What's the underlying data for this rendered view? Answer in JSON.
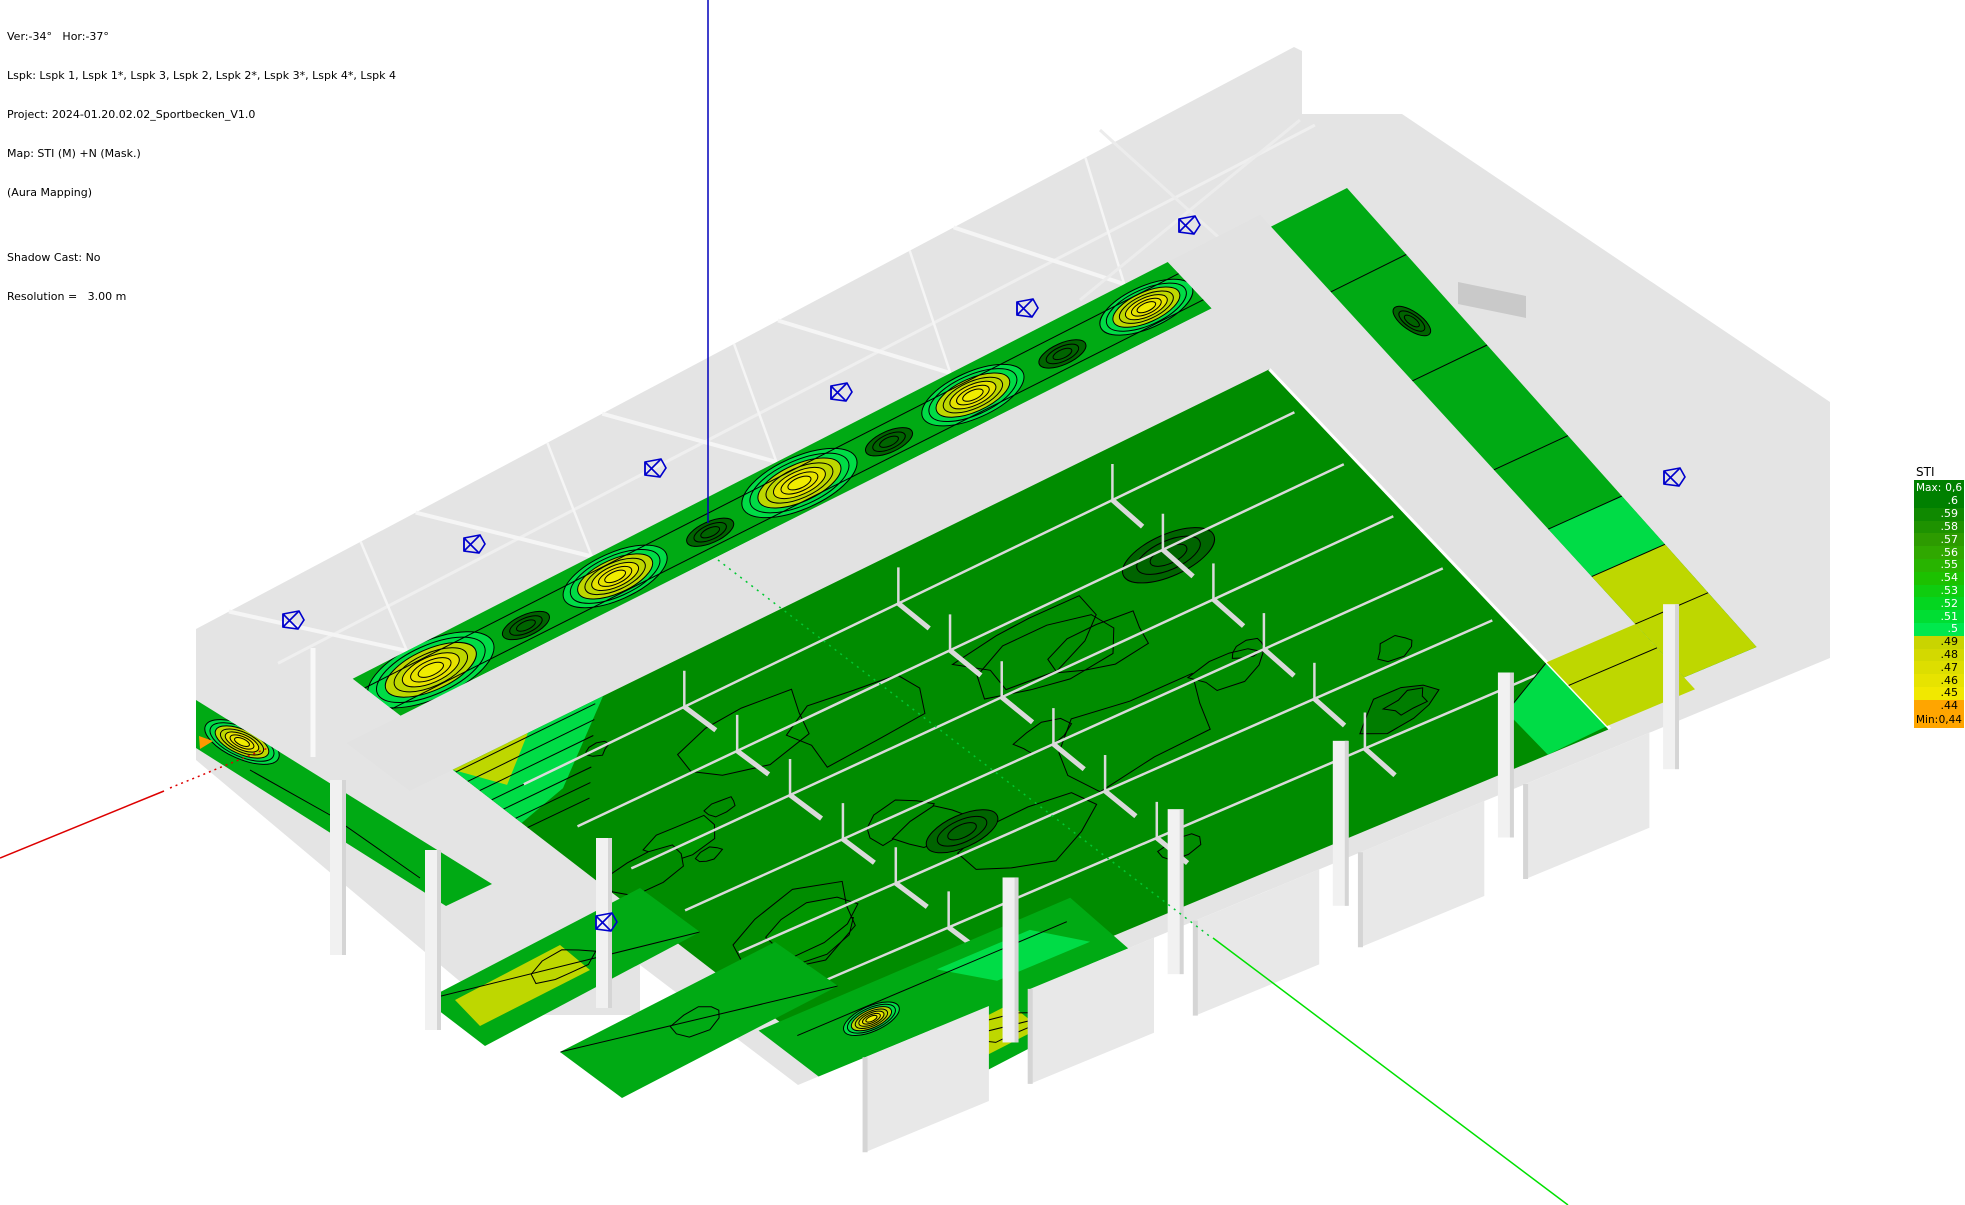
{
  "view": {
    "header_lines": [
      "Ver:-34°   Hor:-37°",
      "Lspk: Lspk 1, Lspk 1*, Lspk 3, Lspk 2, Lspk 2*, Lspk 3*, Lspk 4*, Lspk 4",
      "Project: 2024-01.20.02.02_Sportbecken_V1.0",
      "Map: STI (M) +N (Mask.)",
      "(Aura Mapping)",
      "",
      "Shadow Cast: No",
      "Resolution =   3.00 m"
    ]
  },
  "legend": {
    "title": "STI",
    "header": {
      "key": "Max:",
      "value": "0,6",
      "bg": "#008000",
      "fg": "#FFFFFF"
    },
    "footer": {
      "key": "Min:",
      "value": "0,44",
      "bg": "#FFA500",
      "fg": "#000000"
    },
    "rows": [
      {
        "label": ".6",
        "bg": "#008000",
        "fg": "#FFFFFF"
      },
      {
        "label": ".59",
        "bg": "#0F8900",
        "fg": "#FFFFFF"
      },
      {
        "label": ".58",
        "bg": "#1E9200",
        "fg": "#FFFFFF"
      },
      {
        "label": ".57",
        "bg": "#2D9B00",
        "fg": "#FFFFFF"
      },
      {
        "label": ".56",
        "bg": "#30A800",
        "fg": "#FFFFFF"
      },
      {
        "label": ".55",
        "bg": "#28B400",
        "fg": "#FFFFFF"
      },
      {
        "label": ".54",
        "bg": "#1CC100",
        "fg": "#FFFFFF"
      },
      {
        "label": ".53",
        "bg": "#0FCD0F",
        "fg": "#FFFFFF"
      },
      {
        "label": ".52",
        "bg": "#04D620",
        "fg": "#FFFFFF"
      },
      {
        "label": ".51",
        "bg": "#00DE33",
        "fg": "#FFFFFF"
      },
      {
        "label": ".5",
        "bg": "#00E84D",
        "fg": "#FFFFFF"
      },
      {
        "label": ".49",
        "bg": "#C9D400",
        "fg": "#000000"
      },
      {
        "label": ".48",
        "bg": "#D3D900",
        "fg": "#000000"
      },
      {
        "label": ".47",
        "bg": "#DDDE00",
        "fg": "#000000"
      },
      {
        "label": ".46",
        "bg": "#E7E300",
        "fg": "#000000"
      },
      {
        "label": ".45",
        "bg": "#F1E800",
        "fg": "#000000"
      },
      {
        "label": ".44",
        "bg": "#FFA500",
        "fg": "#000000"
      }
    ]
  },
  "axes": {
    "z_color": "#0000BB",
    "x_color": "#DD0000",
    "y_color": "#00C832",
    "y_solid_color": "#00E000"
  },
  "speakers": {
    "icon": "loudspeaker",
    "color": "#0000CC",
    "count": 8,
    "positions": [
      [
        1190,
        225
      ],
      [
        1028,
        308
      ],
      [
        842,
        392
      ],
      [
        656,
        468
      ],
      [
        475,
        544
      ],
      [
        294,
        620
      ],
      [
        1675,
        477
      ],
      [
        607,
        922
      ]
    ]
  },
  "map": {
    "palette": {
      "shell": "#E4E4E4",
      "walkway": "#E2E2E2",
      "slab": "#E8E8E8",
      "pillar": "#F1F1F1",
      "shade": "#D5D5D5",
      "recess": "#C9C9C9",
      "beam": "#F5F5F5",
      "pool": "#008C00",
      "pool_alt1": "#009600",
      "pool_alt2": "#007D00",
      "strip": "#00AA14",
      "bright": "#00DC46",
      "yellow_green": "#BED700",
      "yellow": "#E7E300",
      "pale_yellow": "#F0EC00",
      "orange": "#FF9900",
      "contour": "#000000",
      "lane": "#DADADA"
    }
  }
}
